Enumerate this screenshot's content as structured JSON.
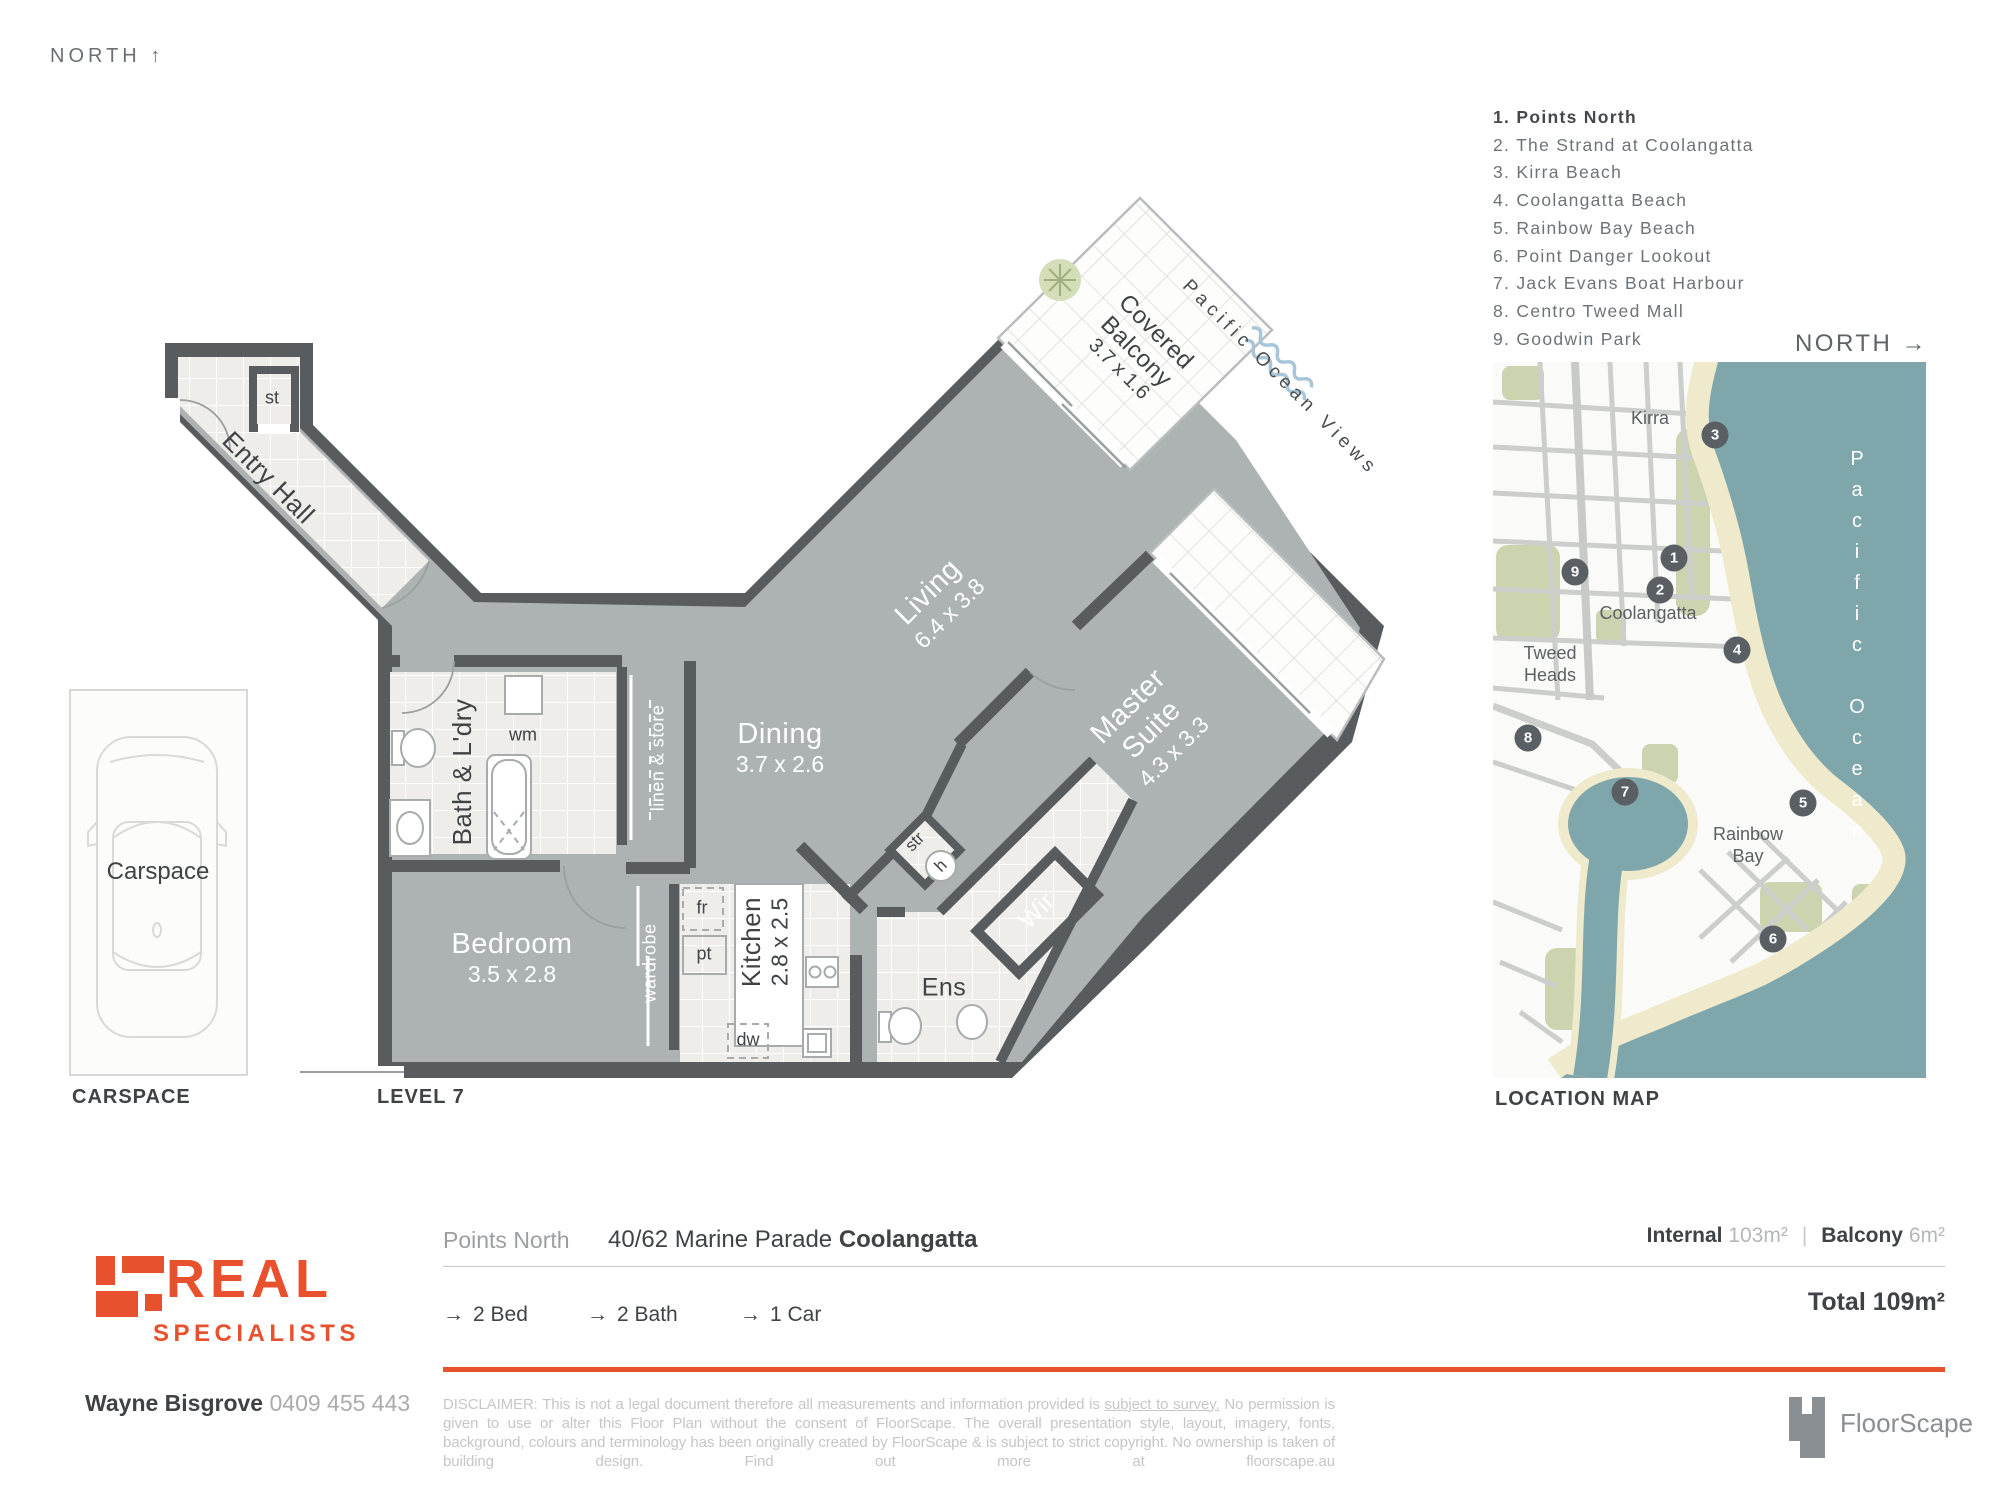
{
  "header": {
    "compass_label": "NORTH",
    "compass_arrow": "↑"
  },
  "poi": {
    "items": [
      {
        "num": "1.",
        "label": "Points North"
      },
      {
        "num": "2.",
        "label": "The Strand at Coolangatta"
      },
      {
        "num": "3.",
        "label": "Kirra Beach"
      },
      {
        "num": "4.",
        "label": "Coolangatta Beach"
      },
      {
        "num": "5.",
        "label": "Rainbow Bay Beach"
      },
      {
        "num": "6.",
        "label": "Point Danger Lookout"
      },
      {
        "num": "7.",
        "label": "Jack Evans Boat Harbour"
      },
      {
        "num": "8.",
        "label": "Centro Tweed Mall"
      },
      {
        "num": "9.",
        "label": "Goodwin Park"
      }
    ]
  },
  "map": {
    "compass_label": "NORTH",
    "compass_arrow": "→",
    "caption": "LOCATION MAP",
    "ocean_label": "Pacific Ocean",
    "labels": {
      "kirra": "Kirra",
      "coolangatta": "Coolangatta",
      "tweed_line1": "Tweed",
      "tweed_line2": "Heads",
      "rainbow_line1": "Rainbow",
      "rainbow_line2": "Bay"
    },
    "markers": [
      "1",
      "2",
      "3",
      "4",
      "5",
      "6",
      "7",
      "8",
      "9"
    ]
  },
  "floorplan": {
    "level_caption": "LEVEL 7",
    "ocean_views": "Pacific Ocean Views",
    "rooms": {
      "entry_hall": "Entry Hall",
      "st": "st",
      "bath": "Bath & L'dry",
      "wm": "wm",
      "linen": "linen & store",
      "bedroom_name": "Bedroom",
      "bedroom_dims": "3.5 x 2.8",
      "wardrobe": "wardrobe",
      "kitchen_name": "Kitchen",
      "kitchen_dims": "2.8 x 2.5",
      "fr": "fr",
      "pt": "pt",
      "dw": "dw",
      "dining_name": "Dining",
      "dining_dims": "3.7 x 2.6",
      "living_name": "Living",
      "living_dims": "6.4 x 3.8",
      "balcony_line1": "Covered",
      "balcony_line2": "Balcony",
      "balcony_dims": "3.7 x 1.6",
      "master_line1": "Master",
      "master_line2": "Suite",
      "master_dims": "4.3 x 3.3",
      "wir": "Wir",
      "ens": "Ens",
      "str": "str",
      "h": "h"
    },
    "carspace": {
      "label": "Carspace",
      "caption": "CARSPACE"
    }
  },
  "footer": {
    "plan_name": "Points North",
    "address_street": "40/62 Marine Parade ",
    "address_suburb": "Coolangatta",
    "feature_arrow": "→",
    "features": [
      {
        "label": "2 Bed"
      },
      {
        "label": "2 Bath"
      },
      {
        "label": "1 Car"
      }
    ],
    "internal_label": "Internal ",
    "internal_value": "103m²",
    "separator": "|",
    "balcony_label": "Balcony ",
    "balcony_value": "6m²",
    "total": "Total 109m²",
    "brand": {
      "line1": "REAL",
      "line2": "SPECIALISTS"
    },
    "agent_name": "Wayne Bisgrove ",
    "agent_phone": "0409 455 443",
    "disclaimer_l1a": "DISCLAIMER: This is not a legal document therefore all measurements and information provided is ",
    "disclaimer_l1b": "subject to survey.",
    "disclaimer_l1c": " No permission is given to use or alter",
    "disclaimer_l2": "this Floor Plan without the consent of FloorScape. The overall presentation style, layout, imagery, fonts, background, colours and terminology has been",
    "disclaimer_l3": "originally created by FloorScape & is subject to strict copyright. No ownership is taken of building design. Find out more at floorscape.au",
    "floorscape": "FloorScape"
  },
  "colors": {
    "accent_orange": "#E8512D",
    "wall": "#585C5F",
    "carpet": "#ACB3B2",
    "tile": "#EFEDEA",
    "ocean": "#7FA6AA",
    "sand": "#EFEACB",
    "park": "#CBD4AE",
    "marker": "#5A5F63",
    "wave_blue": "#A8C6DA"
  }
}
